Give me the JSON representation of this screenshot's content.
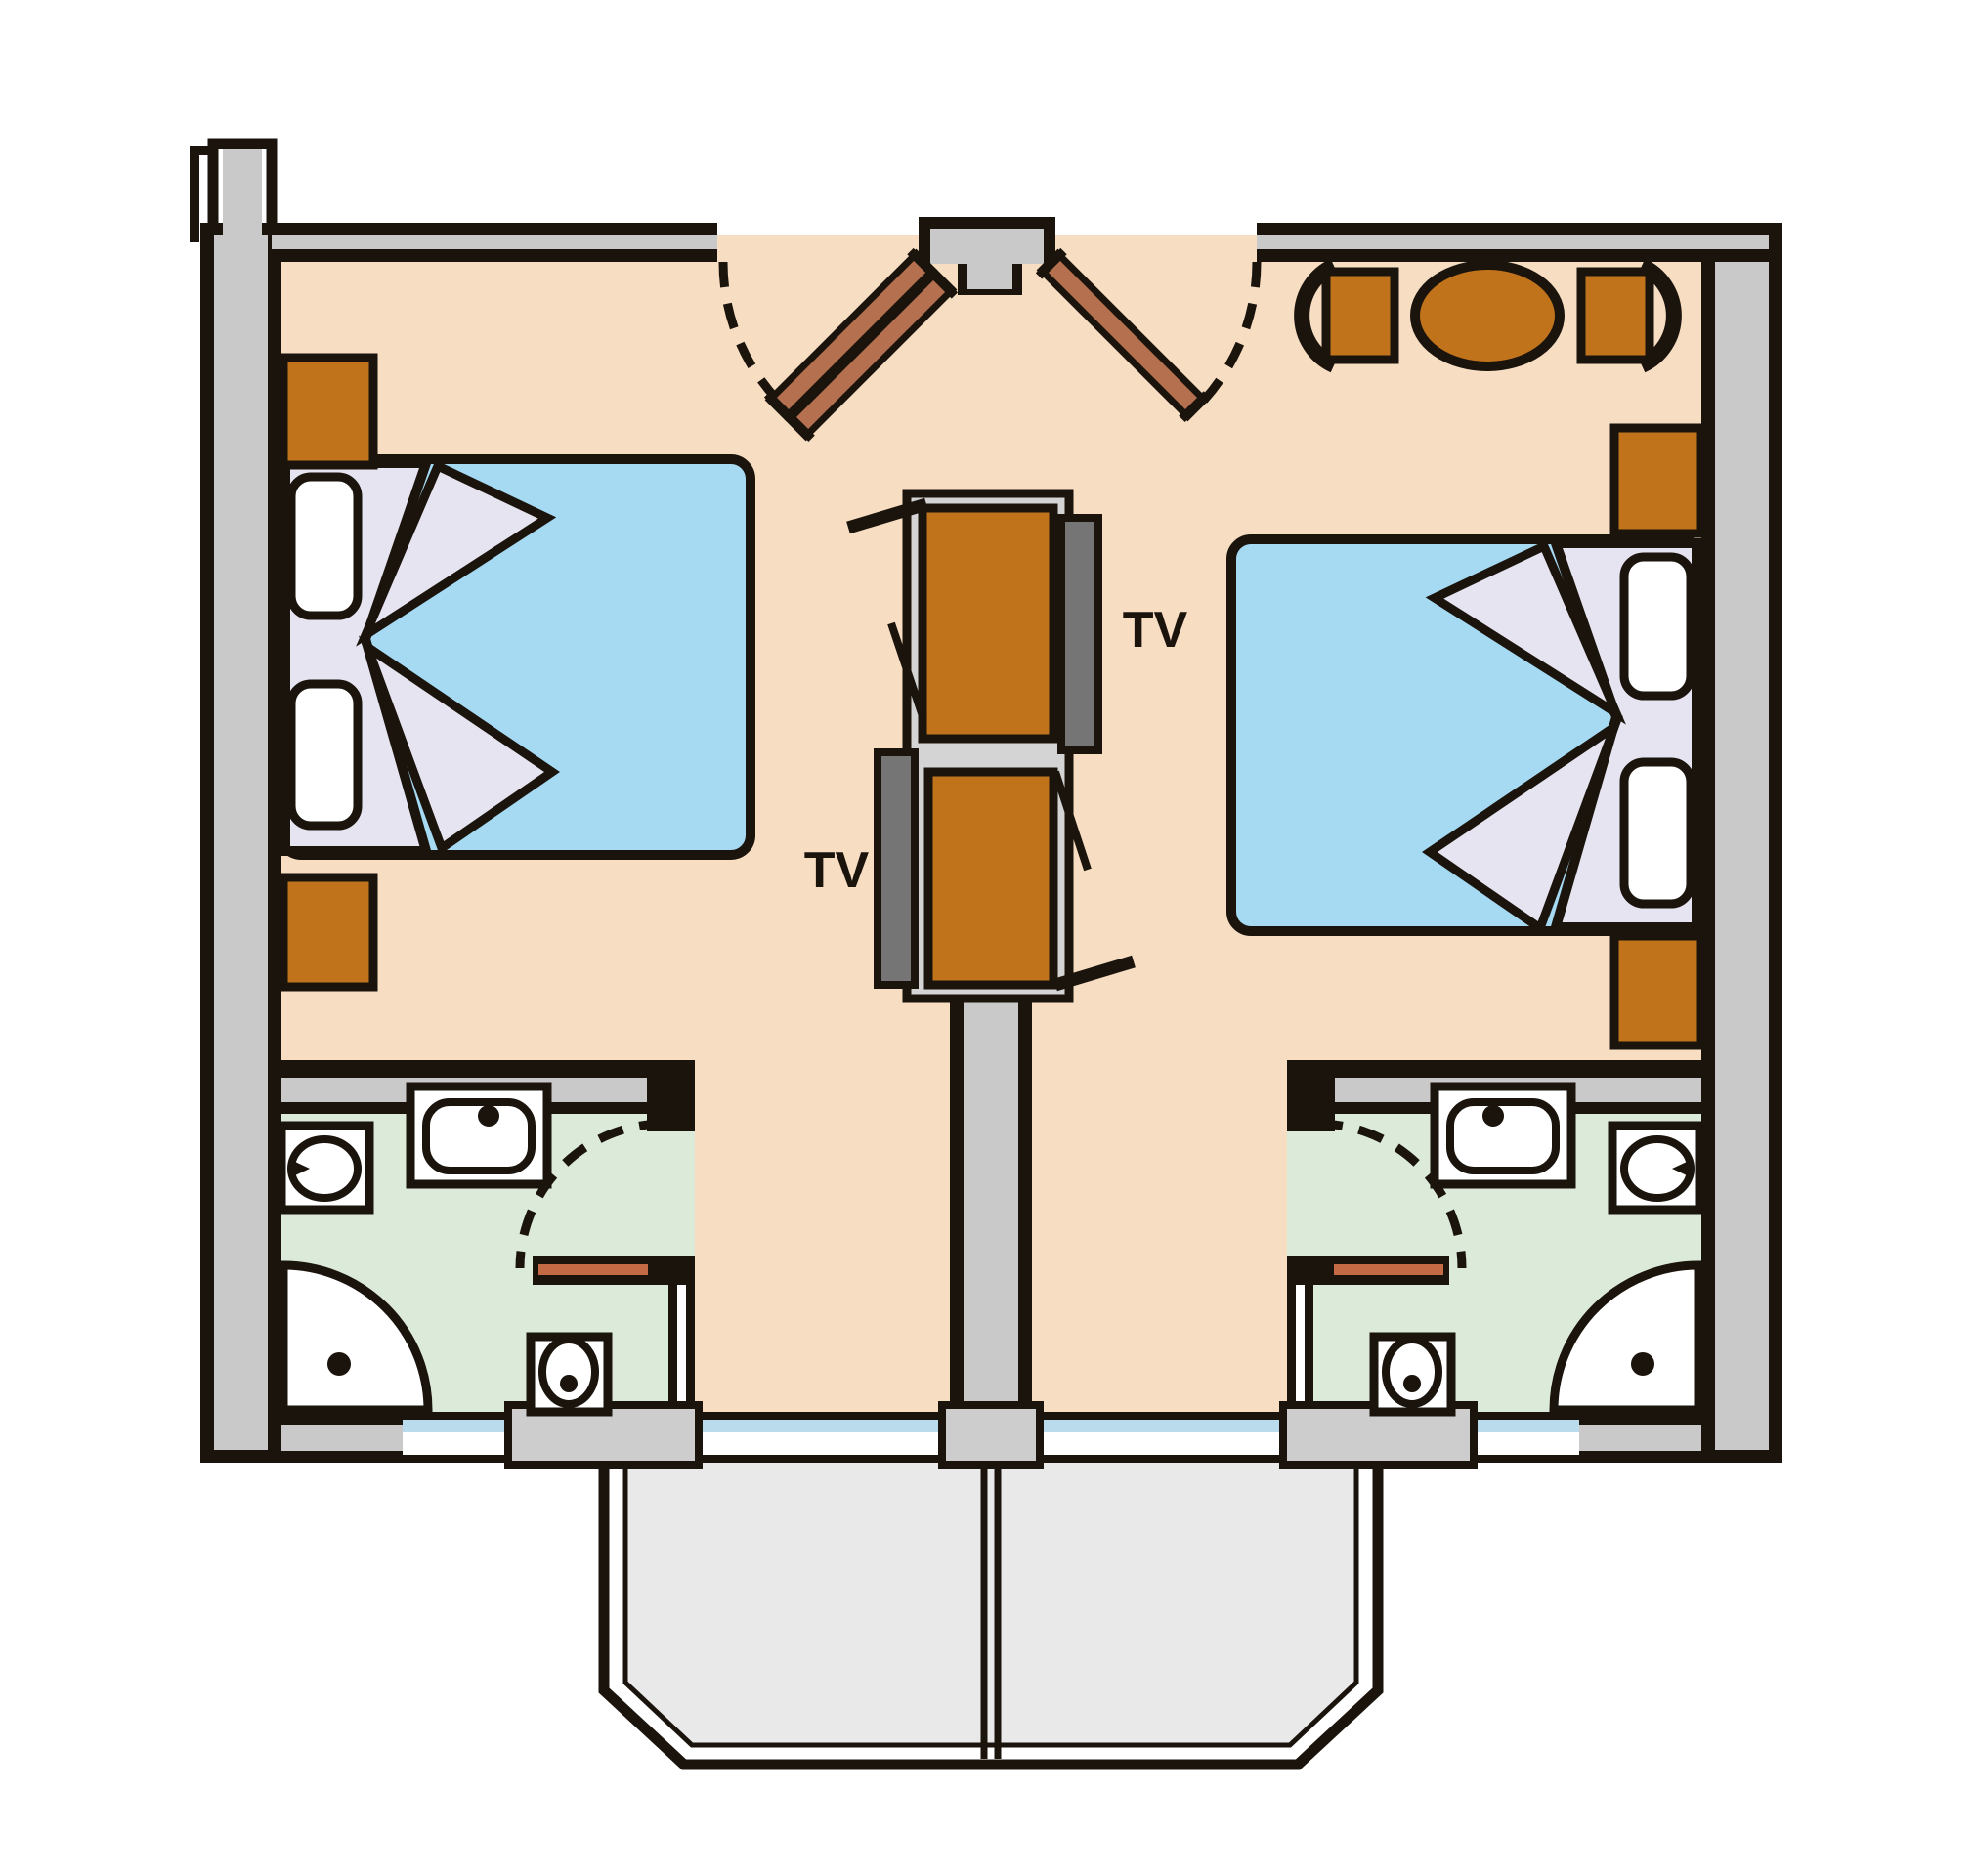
{
  "labels": {
    "tv_left": "TV",
    "tv_right": "TV"
  },
  "palette": {
    "outline": "#1a140d",
    "white": "#ffffff",
    "floor": "#f7ddc2",
    "bath_floor": "#dcead9",
    "wall": "#c9c9c9",
    "pier": "#cdcdcd",
    "platform": "#d4d4d4",
    "balcony": "#e9e9e9",
    "furniture": "#c0731a",
    "entry_door": "#b5714f",
    "bath_door": "#c46b45",
    "bed_blanket": "#a6d9f2",
    "bed_sheet": "#e6e4f0",
    "tv": "#757575",
    "window": "#b9dbeb"
  },
  "plan": {
    "kind": "twin-hotel-room-floor-plan",
    "rooms": [
      {
        "name": "left-bedroom",
        "symbols": [
          "double-bed",
          "pillow",
          "pillow",
          "nightstand",
          "nightstand",
          "tv-cabinet",
          "tv-screen",
          "entry-door",
          "door-swing-arc"
        ]
      },
      {
        "name": "right-bedroom",
        "symbols": [
          "double-bed",
          "pillow",
          "pillow",
          "side-cabinet",
          "side-cabinet",
          "oval-table",
          "chair",
          "chair",
          "tv-cabinet",
          "tv-screen",
          "entry-door",
          "door-swing-arc"
        ]
      },
      {
        "name": "left-bathroom",
        "symbols": [
          "washbasin",
          "bidet",
          "corner-shower",
          "toilet",
          "bath-door",
          "door-swing-arc"
        ]
      },
      {
        "name": "right-bathroom",
        "symbols": [
          "washbasin",
          "bidet",
          "corner-shower",
          "toilet",
          "bath-door",
          "door-swing-arc"
        ]
      },
      {
        "name": "balcony",
        "symbols": [
          "balcony-divider",
          "window-strip",
          "window-strip",
          "window-strip",
          "window-strip"
        ]
      }
    ]
  }
}
